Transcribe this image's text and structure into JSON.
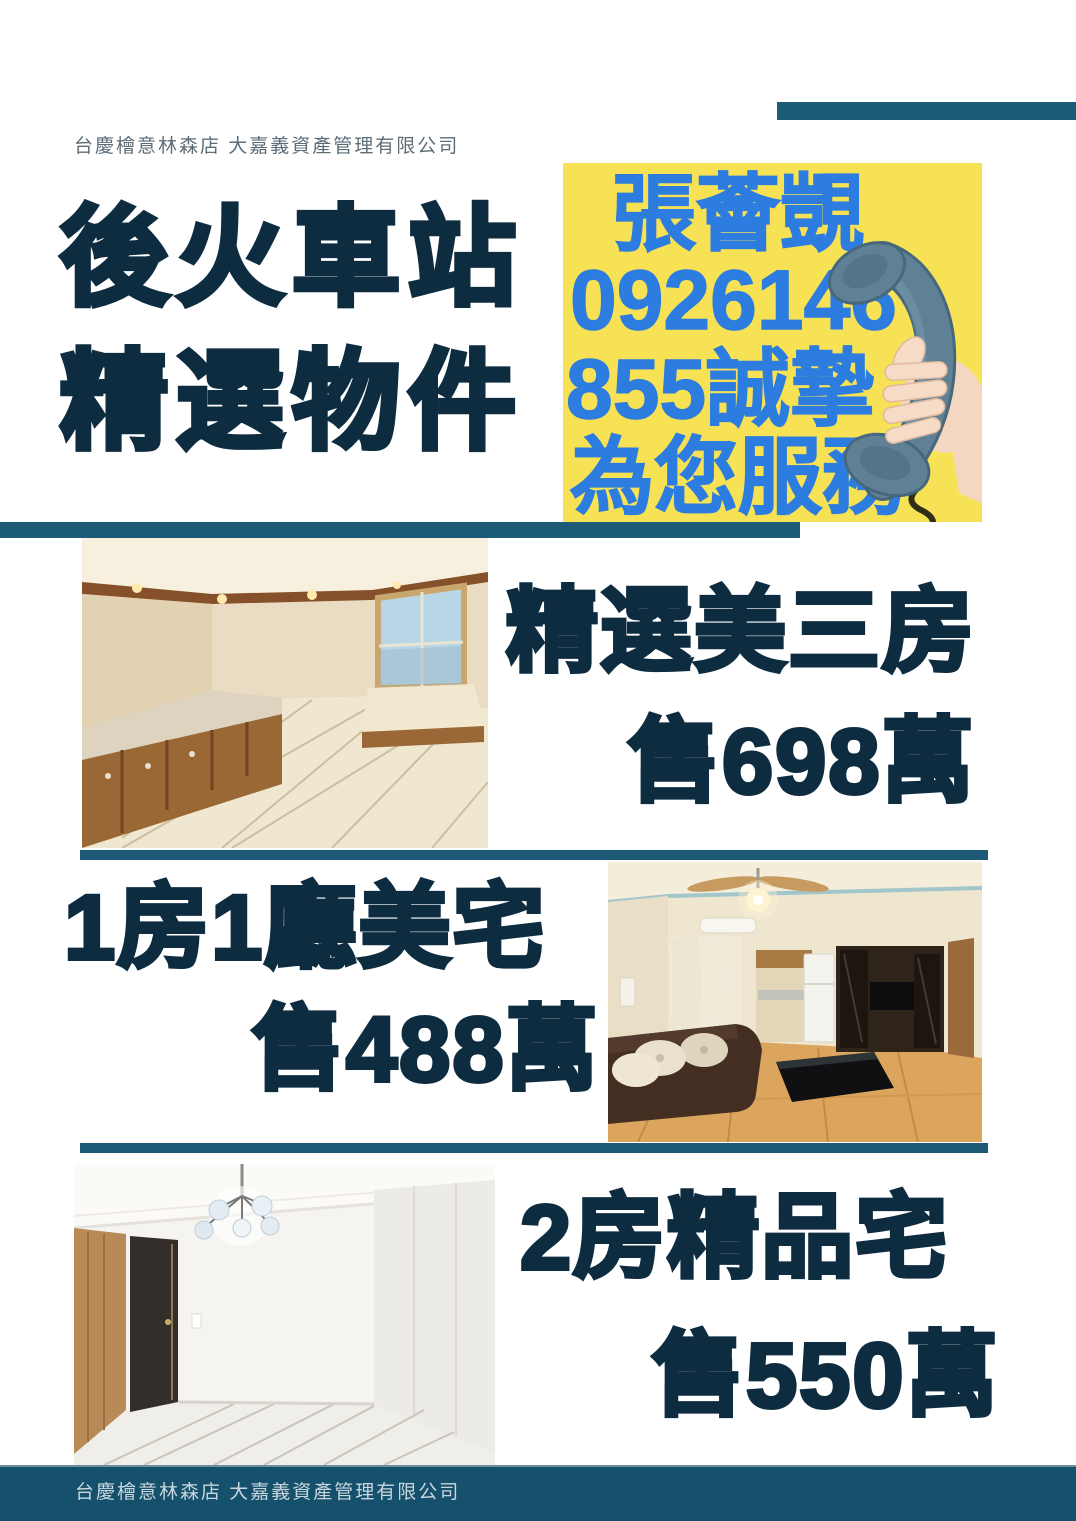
{
  "header": {
    "company": "台慶檜意林森店 大嘉義資產管理有限公司"
  },
  "title": {
    "line1": "後火車站",
    "line2": "精選物件"
  },
  "contact": {
    "lines": [
      "張薈覬",
      "0926146",
      "855誠摯",
      "為您服務"
    ],
    "agent_name": "張薈覬",
    "phone": "0926146855",
    "tagline": "誠摯為您服務",
    "illustration": "hand-holding-telephone-handset"
  },
  "listings": [
    {
      "title": "精選美三房",
      "price": "售698萬",
      "photo_desc": "empty room with wood cabinets, marble counter, window with sky view, beige tile floor"
    },
    {
      "title": "1房1廳美宅",
      "price": "售488萬",
      "photo_desc": "furnished living room with ceiling fan, brown sofa, black coffee table, dark TV cabinet, wood floor"
    },
    {
      "title": "2房精品宅",
      "price": "售550萬",
      "photo_desc": "bright white empty room with globe chandelier, dark door, wood accent wall, white tile floor"
    }
  ],
  "footer": {
    "company": "台慶檜意林森店 大嘉義資產管理有限公司"
  },
  "colors": {
    "navy_text": "#0e2c40",
    "divider_teal": "#1d5a78",
    "footer_teal": "#15506c",
    "contact_yellow": "#f7e256",
    "contact_blue": "#2d7cdf",
    "handset_blue": "#5f8095"
  }
}
